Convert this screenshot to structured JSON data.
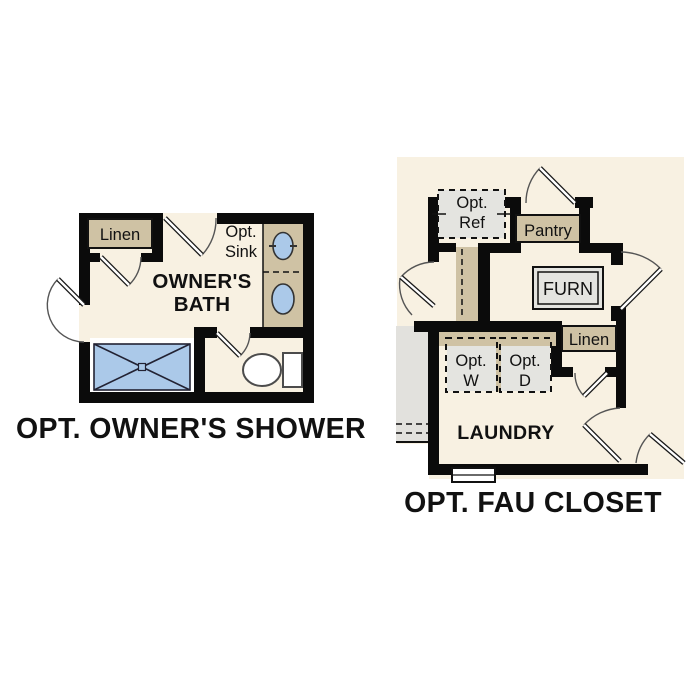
{
  "colors": {
    "floor": "#f8f1e2",
    "wall": "#0b0b0b",
    "tan": "#cfc2a4",
    "appliance_gray": "#e4e4e0",
    "adjacent_gray": "#e2e1dd",
    "fixture_blue": "#abc9e9",
    "white": "#ffffff"
  },
  "left_plan": {
    "title": "OPT. OWNER'S SHOWER",
    "room": {
      "line1": "OWNER'S",
      "line2": "BATH"
    },
    "labels": {
      "linen": "Linen",
      "opt_sink_line1": "Opt.",
      "opt_sink_line2": "Sink"
    }
  },
  "right_plan": {
    "title": "OPT. FAU CLOSET",
    "room": "LAUNDRY",
    "labels": {
      "opt_ref_line1": "Opt.",
      "opt_ref_line2": "Ref",
      "pantry": "Pantry",
      "furnace": "FURN",
      "linen": "Linen",
      "opt_washer_line1": "Opt.",
      "opt_washer_line2": "W",
      "opt_dryer_line1": "Opt.",
      "opt_dryer_line2": "D"
    }
  }
}
